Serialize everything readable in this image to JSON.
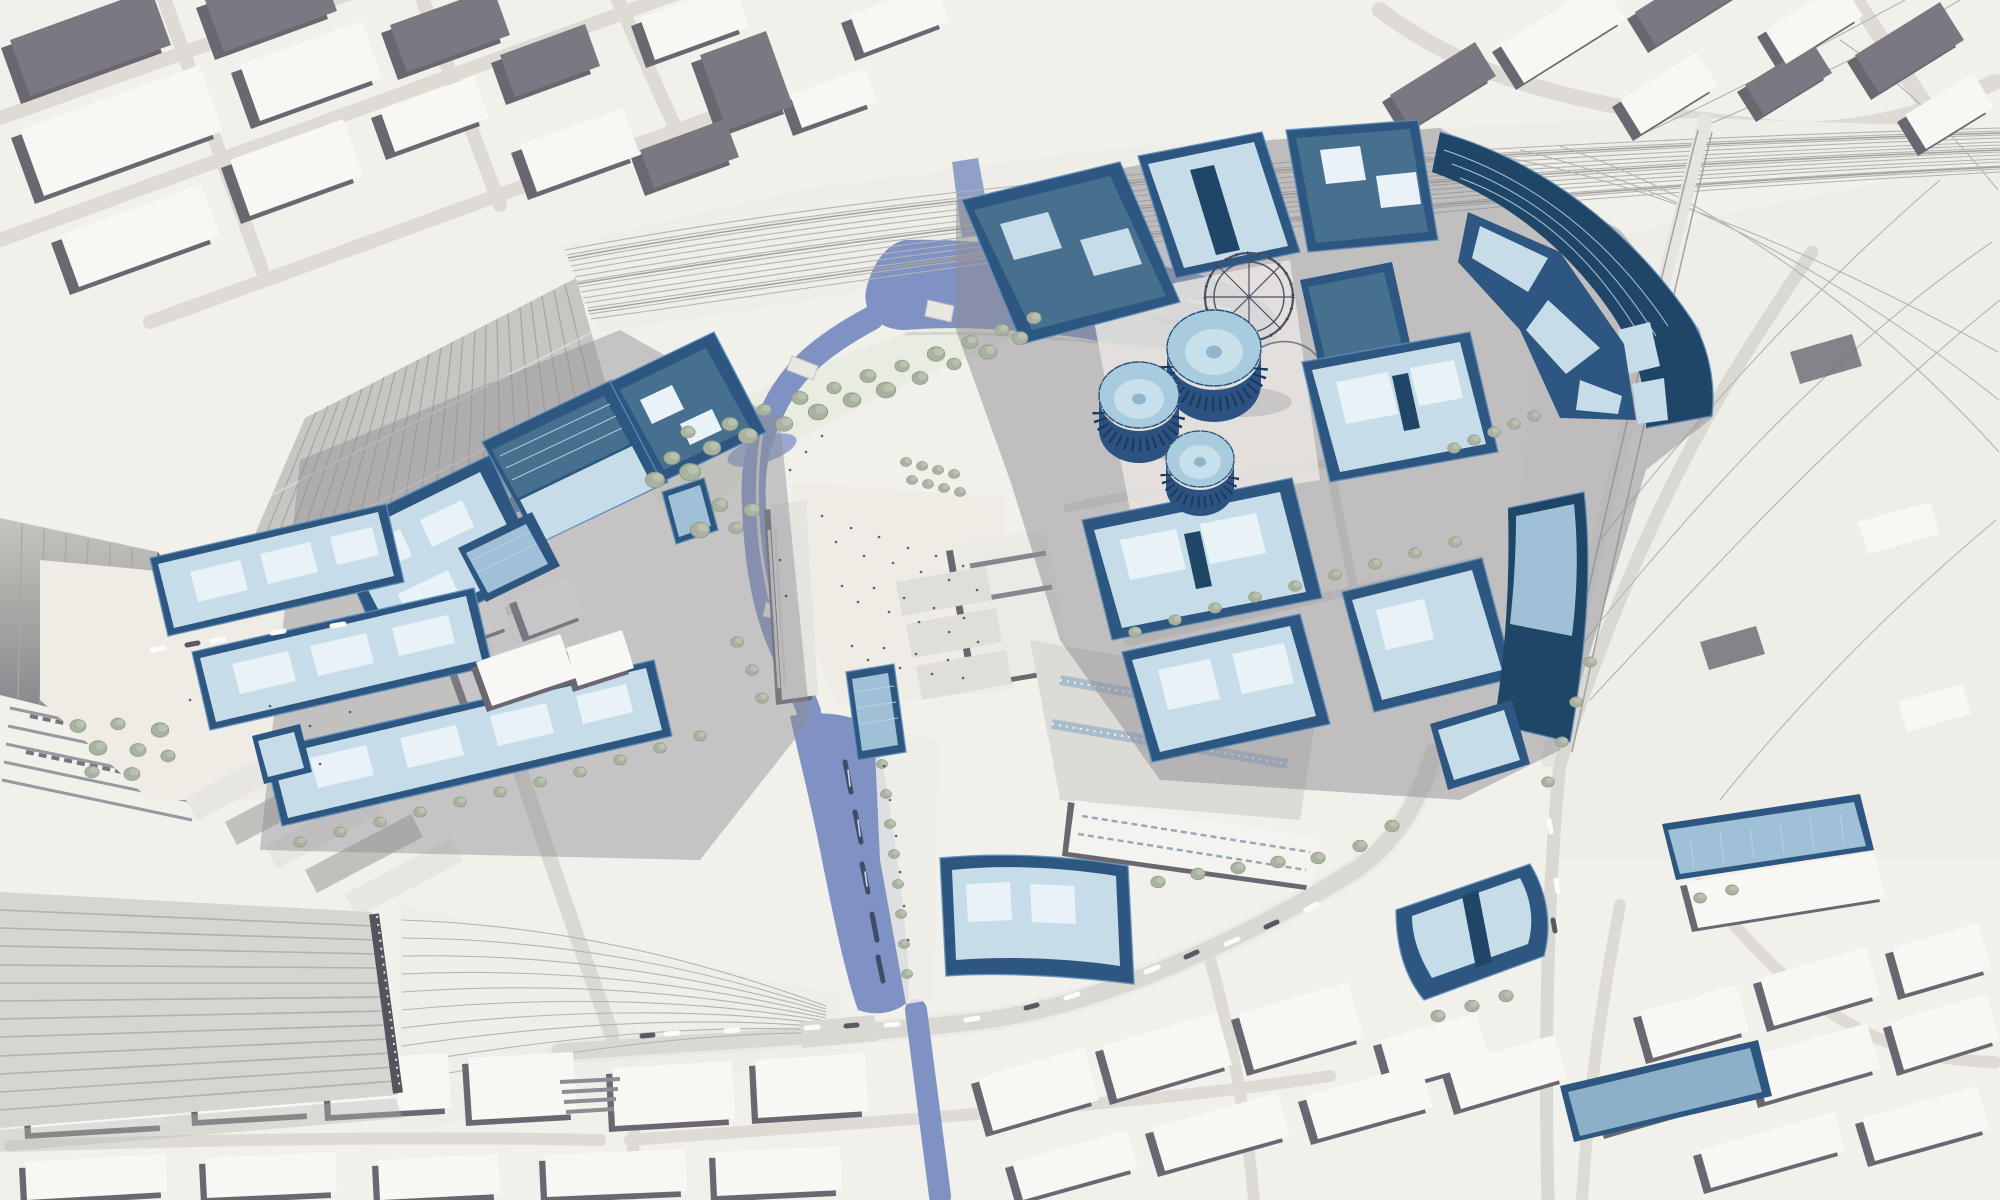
{
  "scene": {
    "type": "aerial-3d-masterplan-rendering",
    "view": "bird's-eye view of a railway-lands regeneration site",
    "features": [
      "large ribbed station trainshed",
      "arched trainshed and southern multi-ridge trainshed",
      "fanning railway tracks and viaducts",
      "canal with two mooring basins and boats",
      "three gasholder drums with a skeletal guide frame",
      "blue glass proposed development blocks",
      "white and grey existing city massing",
      "tree-lined streets, park band and central plaza with pedestrians"
    ],
    "highlight_scheme": {
      "proposed_buildings": "steel blue with pale glass roofs",
      "existing_context": "white massing with grey walls"
    }
  },
  "palette": {
    "ground": "#f2f0eb",
    "plaza": "#efece6",
    "road": "#dad8d2",
    "street_dark": "#8f8c93",
    "existing_wall": "#6a6771",
    "existing_wall_light": "#9b98a1",
    "existing_roof": "#f8f7f3",
    "existing_roof_gray": "#7b7881",
    "shed_roof": "#c8c6c2",
    "shed_rib": "#a9a7a3",
    "shed_dark": "#56535d",
    "track": "#b5b3af",
    "rail_land": "#efede8",
    "water": "#8092c3",
    "water_deep": "#6a7cb2",
    "water_light": "#9aa8d1",
    "park": "#e8ebdf",
    "tree": "#a9b2a0",
    "tree_dark": "#909b88",
    "blue_wall": "#2d5780",
    "blue_wall_deep": "#1f4567",
    "blue_roof": "#c7dce9",
    "blue_roof_mid": "#9fc0d6",
    "blue_glass": "#47708f",
    "blue_edge": "#5e8db9",
    "blue_inset": "#e9f2f7",
    "gas_drum": "#2b5280",
    "gas_rib": "#1c3a5d",
    "gas_top": "#a8cbdd",
    "gas_top_inner": "#c8dfec",
    "gas_frame": "#4b5263",
    "people": "#4c4c55",
    "boat": "#3e4c68",
    "car_light": "#fbfbf9",
    "car_dark": "#5a5862",
    "shadow": "#b9b7b2"
  }
}
